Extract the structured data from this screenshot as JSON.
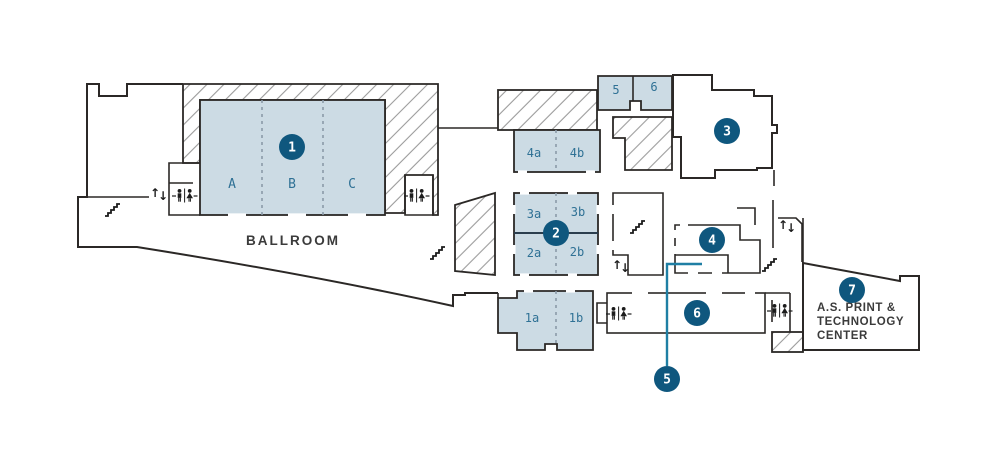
{
  "colors": {
    "wall": "#2b2826",
    "room_fill": "#ccdbe4",
    "highlight_fill": "#f6a91f",
    "marker_fill": "#0f577e",
    "marker_text": "#ffffff",
    "room_label": "#2f7195",
    "hatch_line": "#9b9b9b",
    "callout_line": "#1f7fa4",
    "caption_text": "#3b3b3b"
  },
  "ballroom": {
    "caption": "BALLROOM",
    "sections": [
      "A",
      "B",
      "C"
    ]
  },
  "rooms": {
    "cluster4": [
      "4a",
      "4b"
    ],
    "top": [
      "5",
      "6"
    ],
    "cluster3": [
      "3a",
      "3b"
    ],
    "cluster2": [
      "2a",
      "2b"
    ],
    "cluster1": [
      "1a",
      "1b"
    ]
  },
  "markers": [
    "1",
    "2",
    "3",
    "4",
    "5",
    "6",
    "7"
  ],
  "print_center": {
    "lines": [
      "A.S. PRINT &",
      "TECHNOLOGY",
      "CENTER"
    ]
  },
  "icons": {
    "elevator_up": "↑",
    "elevator_down": "↓"
  }
}
